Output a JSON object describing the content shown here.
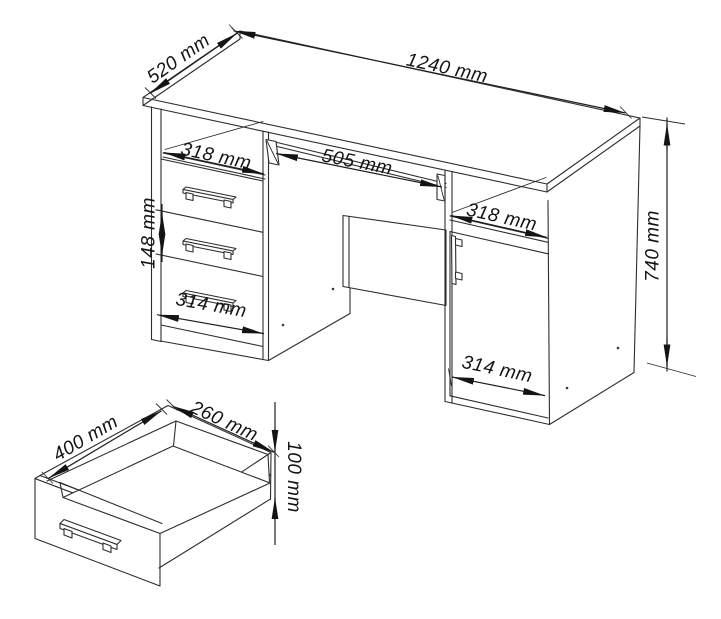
{
  "drawing": {
    "title": "desk-technical-dimension-drawing",
    "background_color": "#ffffff",
    "line_color": "#2d2d2d",
    "label_color": "#141414",
    "desk": {
      "labels": {
        "top_width": "1240 mm",
        "top_depth": "520 mm",
        "left_shelf_width": "318 mm",
        "keyboard_tray_width": "505 mm",
        "right_shelf_width": "318 mm",
        "middle_drawer_height": "148 mm",
        "left_pedestal_width": "314 mm",
        "right_pedestal_width": "314 mm",
        "overall_height": "740 mm"
      }
    },
    "drawer": {
      "labels": {
        "depth": "400 mm",
        "width": "260 mm",
        "height": "100 mm"
      }
    }
  }
}
